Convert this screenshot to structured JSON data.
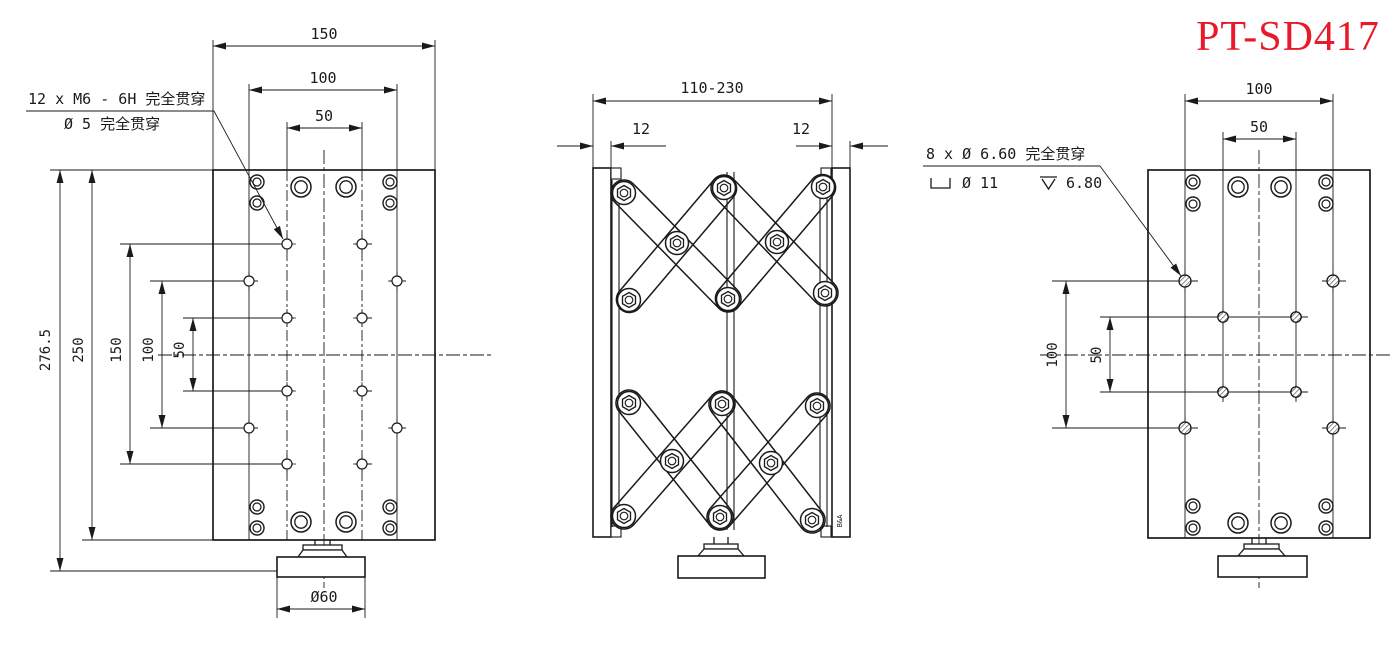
{
  "title": {
    "text": "PT-SD417",
    "color": "#e8192b"
  },
  "colors": {
    "line": "#1a1a1a",
    "background": "#ffffff",
    "accent_red": "#e8192b"
  },
  "views": {
    "top_plate": {
      "width_dims": [
        "150",
        "100",
        "50"
      ],
      "height_dims": [
        "276.5",
        "250",
        "150",
        "100",
        "50"
      ],
      "base_diameter": "Ø60",
      "leader": {
        "line1": "12 x  M6 - 6H 完全贯穿",
        "line2": "Ø 5 完全贯穿"
      }
    },
    "side": {
      "travel_range": "110-230",
      "plate_thickness_left": "12",
      "plate_thickness_right": "12",
      "mark": "B&A"
    },
    "bottom_plate": {
      "width_dims": [
        "100",
        "50"
      ],
      "height_dims": [
        "100",
        "50"
      ],
      "leader": {
        "line1": "8 x Ø 6.60 完全贯穿",
        "line2_cbore": "Ø 11",
        "line2_depth": "6.80"
      }
    }
  }
}
